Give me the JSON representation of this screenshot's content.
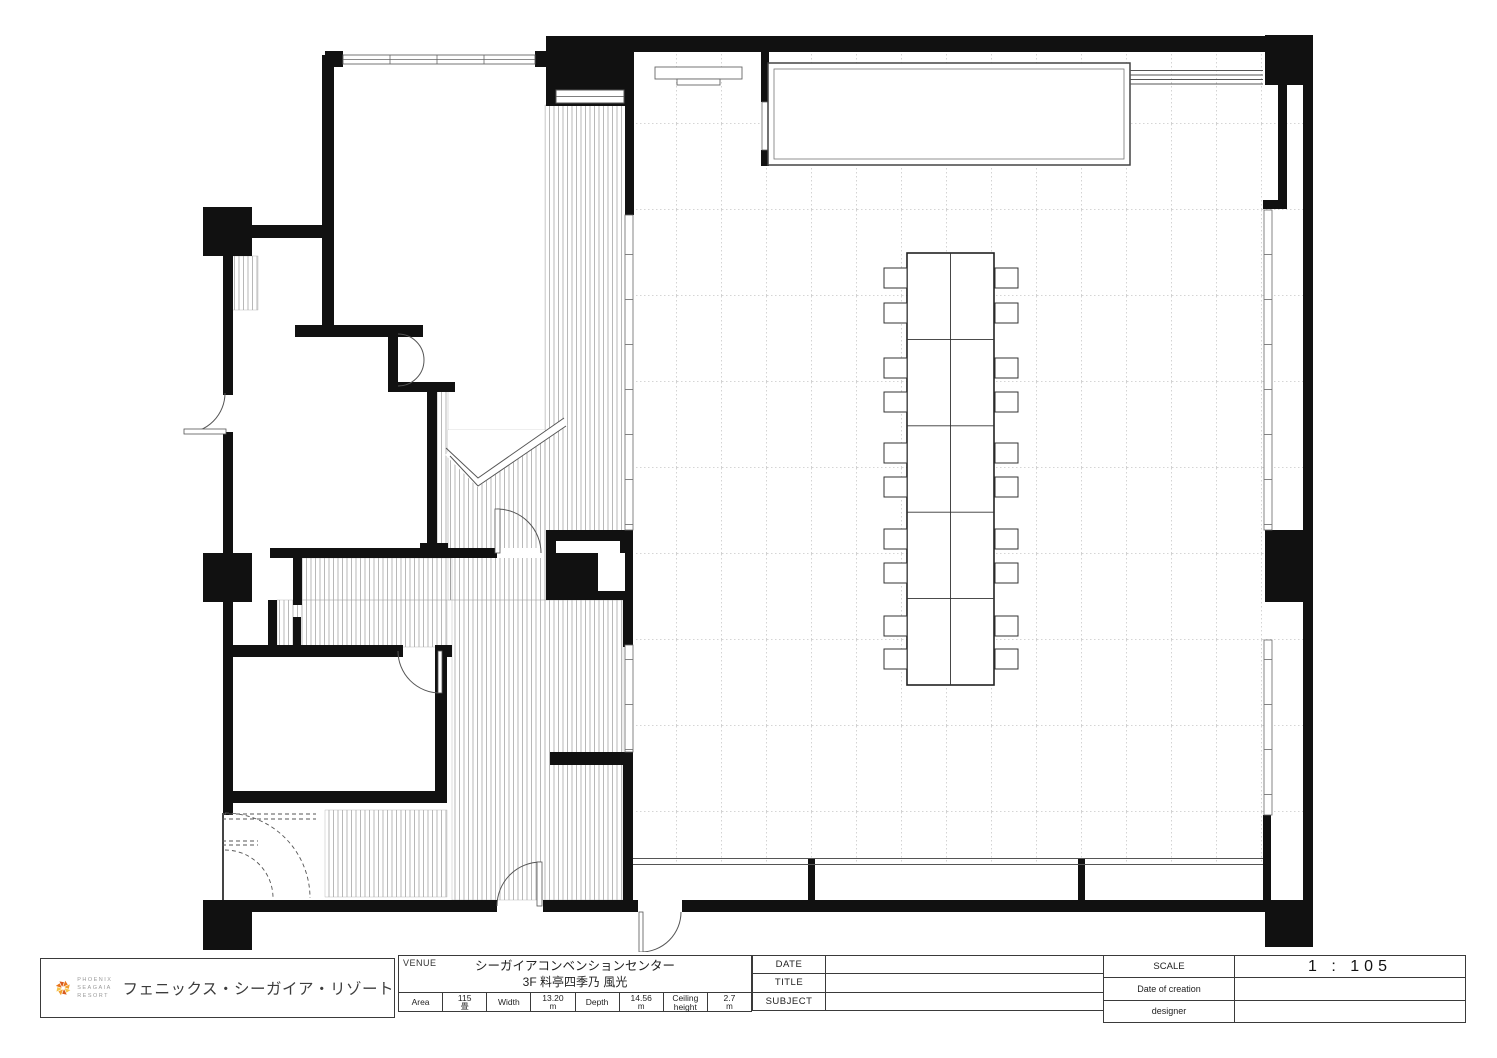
{
  "title_block": {
    "brand": {
      "name_line1": "PHOENIX",
      "name_line2": "SEAGAIA",
      "name_line3": "RESORT",
      "name_jp": "フェニックス・シーガイア・リゾート"
    },
    "venue": {
      "label": "VENUE",
      "line1": "シーガイアコンベンションセンター",
      "line2": "3F 料亭四季乃 風光"
    },
    "specs": [
      {
        "label": "Area",
        "value": "115",
        "unit": "畳"
      },
      {
        "label": "Width",
        "value": "13.20",
        "unit": "m"
      },
      {
        "label": "Depth",
        "value": "14.56",
        "unit": "m"
      },
      {
        "label": "Ceiling height",
        "value": "2.7",
        "unit": "m"
      }
    ],
    "meta": [
      {
        "label": "DATE",
        "value": ""
      },
      {
        "label": "TITLE",
        "value": ""
      },
      {
        "label": "SUBJECT",
        "value": ""
      }
    ],
    "print": [
      {
        "label": "SCALE",
        "value": "1 : 105"
      },
      {
        "label": "Date of creation",
        "value": ""
      },
      {
        "label": "designer",
        "value": ""
      }
    ]
  },
  "colors": {
    "wall": "#111111",
    "hatch": "#999999",
    "grid": "#c8c8c8",
    "line": "#555555",
    "logo_orange": "#e8741c",
    "logo_amber": "#f2a02e",
    "logo_yellow": "#f6c44a",
    "logo_red": "#d85a1d"
  }
}
